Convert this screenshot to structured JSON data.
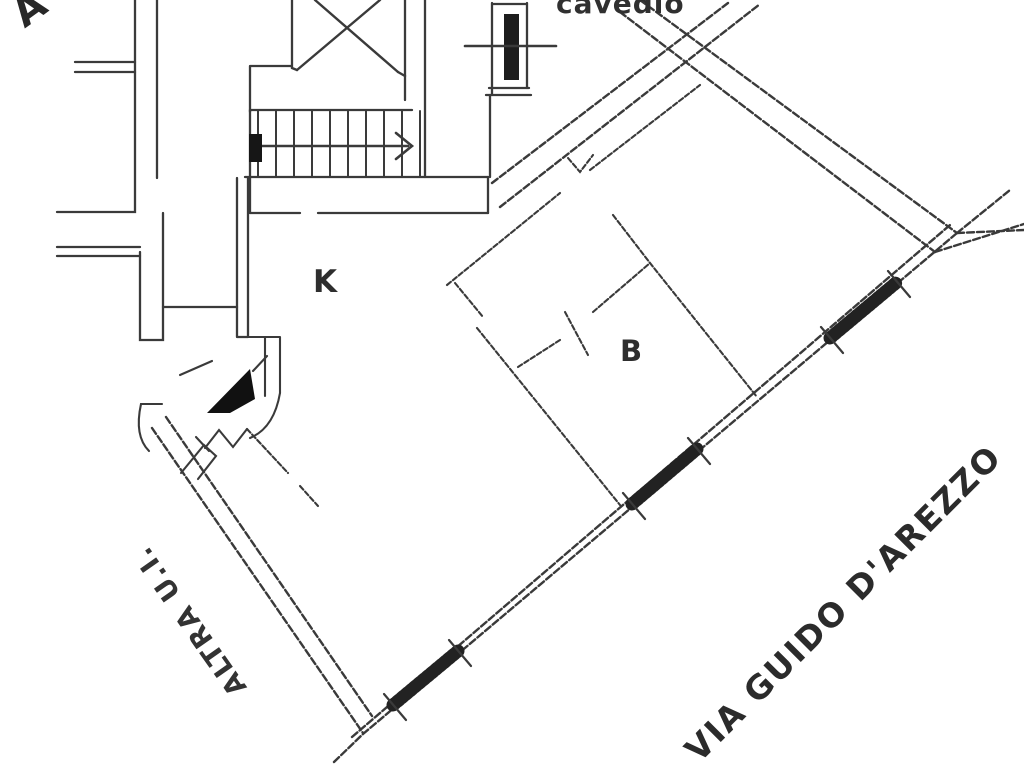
{
  "meta": {
    "kind": "scanned-floor-plan",
    "width_px": 1024,
    "height_px": 768
  },
  "colors": {
    "background": "#ffffff",
    "wall_line": "#3a3a3a",
    "dark_fill": "#161616",
    "text": "#2b2b2b"
  },
  "labels": {
    "corner_letter": "A",
    "shaft": "cavedio",
    "kitchen": "K",
    "bathroom": "B",
    "other_unit": "ALTRA U.I.",
    "street": "VIA GUIDO D'AREZZO"
  },
  "plan_features": {
    "staircase": "stair flight with treads and up-direction arrow",
    "shaft_room": "room crossed by X (void above stairwell)",
    "flue": "hatched chimney/duct section at top",
    "windows": [
      "living-room window",
      "middle-room window",
      "bedroom window"
    ],
    "entrance_marker": "solid black arrow at unit entrance",
    "door_swings": "quarter-circle door arcs and leaf ticks"
  }
}
